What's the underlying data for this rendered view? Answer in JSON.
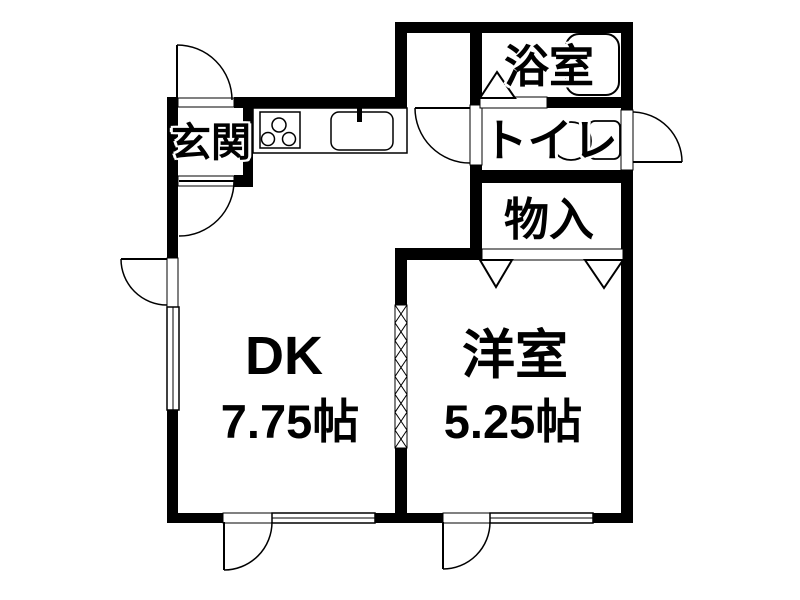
{
  "plan": {
    "background_color": "#ffffff",
    "wall_color": "#000000",
    "line_color": "#000000",
    "text_color": "#000000",
    "rooms": {
      "genkan": {
        "label": "玄関"
      },
      "bathroom": {
        "label": "浴室"
      },
      "toilet": {
        "label": "トイレ"
      },
      "storage": {
        "label": "物入"
      },
      "dining_kitchen": {
        "label": "DK",
        "size": "7.75帖"
      },
      "western_room": {
        "label": "洋室",
        "size": "5.25帖"
      }
    },
    "fixtures": {
      "bathtub": "bathtub",
      "toilet_bowl": "toilet-bowl",
      "stove": "3-burner-stove",
      "sink": "kitchen-sink",
      "counter": "kitchen-counter"
    }
  }
}
